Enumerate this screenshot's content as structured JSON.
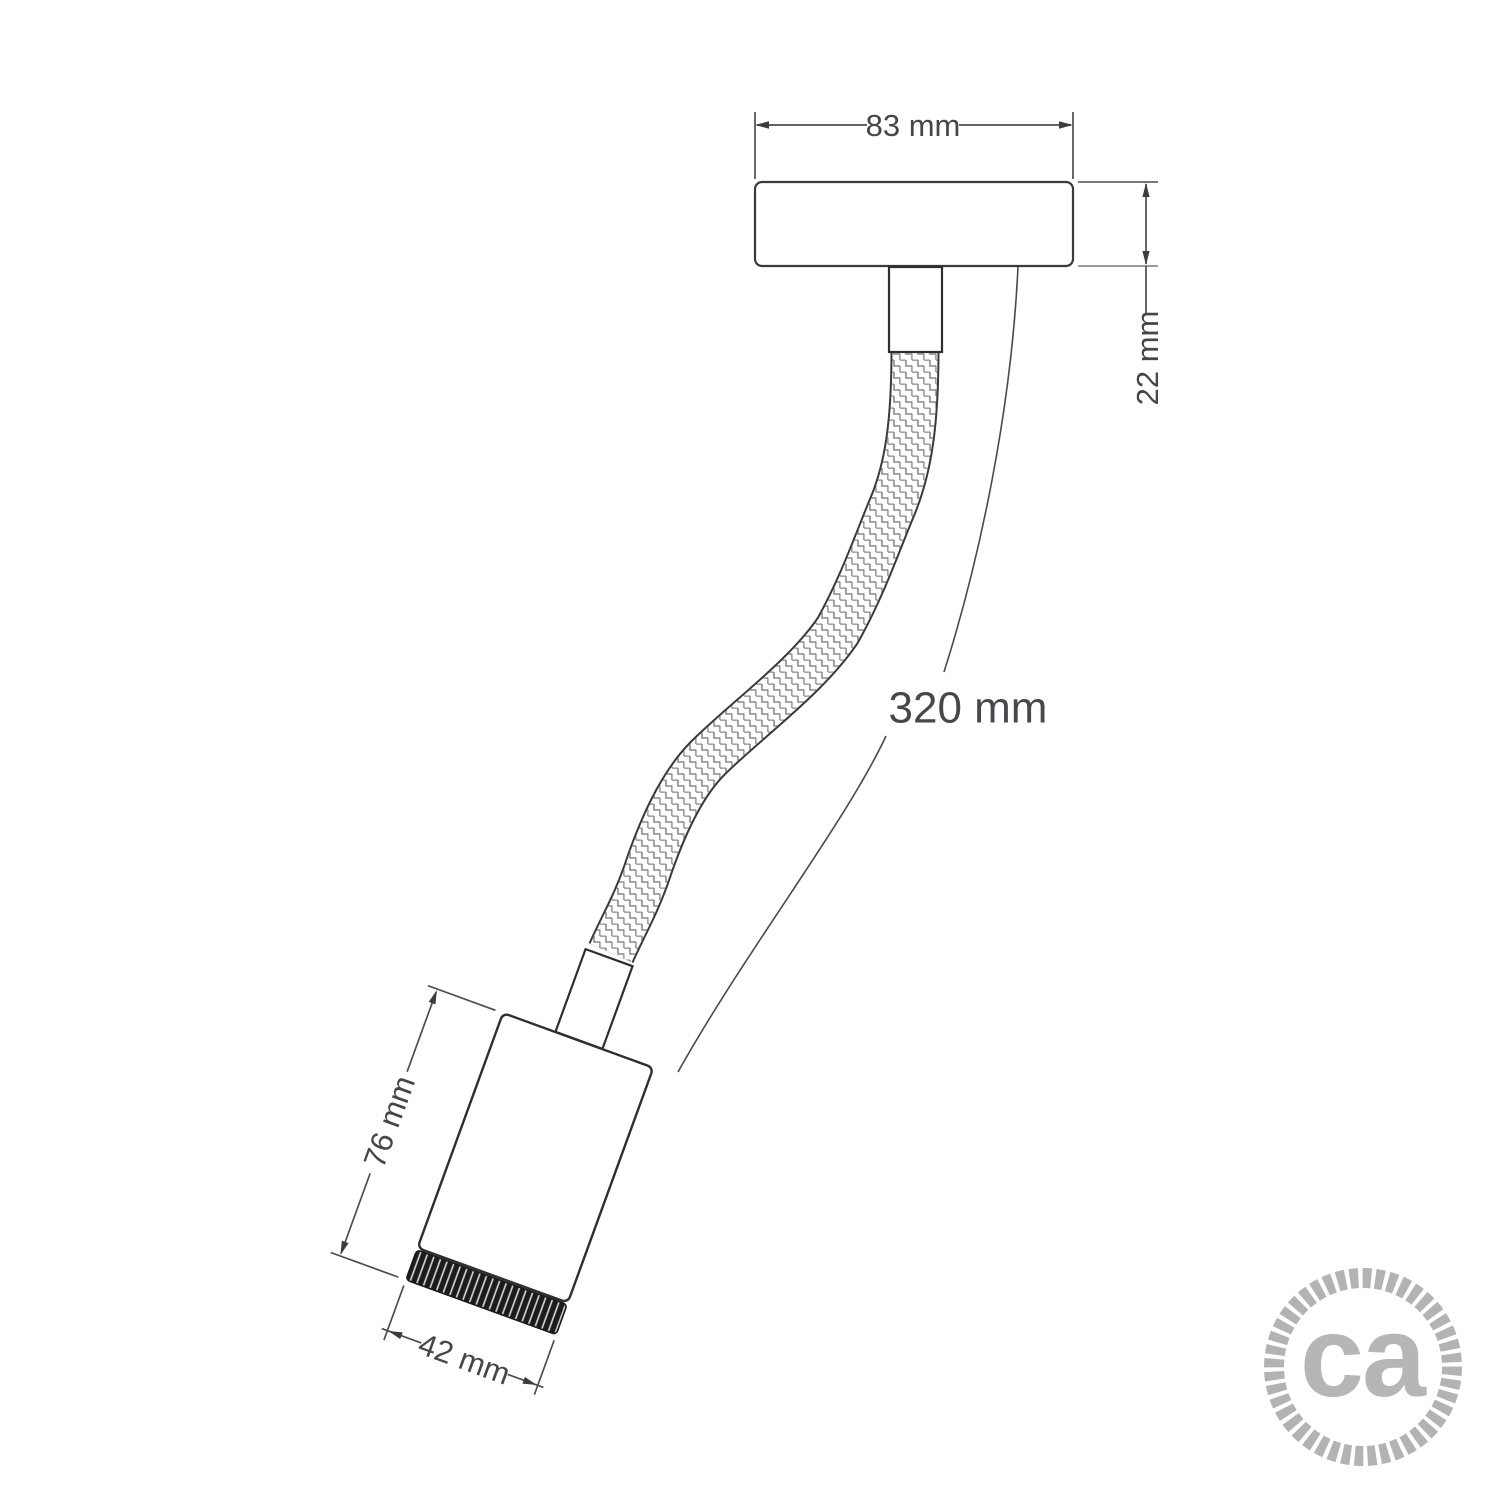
{
  "meta": {
    "kind": "technical dimension drawing",
    "product": "flexible wall/ceiling spot lamp with canopy, braided flex arm and cylindrical lamp holder",
    "colors": {
      "background": "#ffffff",
      "outline": "#2e2e2e",
      "dim_line": "#4d4d4d",
      "dim_text": "#45454b",
      "light_line": "#9a9a9a",
      "braid_texture": "#8a8a8a",
      "knurl_fill": "#1c1c1c",
      "logo_gray": "#b4b4b4"
    }
  },
  "labels": {
    "canopy_width": "83 mm",
    "canopy_height": "22 mm",
    "arm_length": "320 mm",
    "body_height": "76 mm",
    "body_diameter": "42 mm"
  },
  "logo": {
    "text": "ca"
  }
}
